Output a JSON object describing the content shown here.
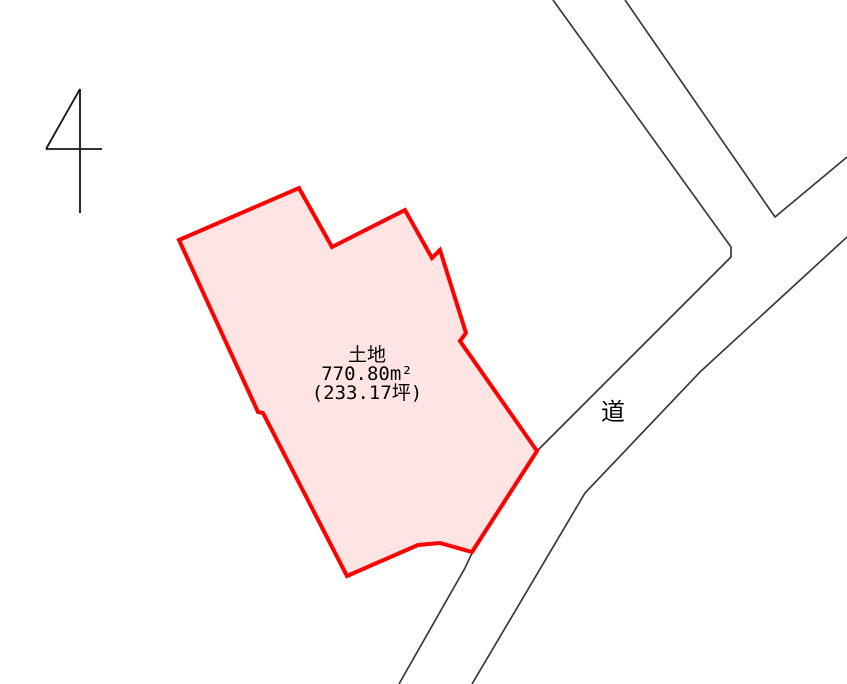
{
  "canvas": {
    "width": 847,
    "height": 684,
    "background": "#ffffff"
  },
  "colors": {
    "parcel_fill": "#fee4e2",
    "parcel_stroke": "#ff0000",
    "road_stroke": "#3a3a3a",
    "text": "#000000"
  },
  "north_arrow": {
    "strokes": [
      "80,89 80,213",
      "46,149 102,149",
      "80,89 46,149"
    ]
  },
  "parcel": {
    "points": "179,240 299,188 332,247 405,210 432,258 440,250 466,333 460,341 537,451 472,552 440,543 418,545 347,576 263,413 258,412",
    "label": {
      "title": "土地",
      "area_m2": "770.80m²",
      "area_tsubo": "(233.17坪)"
    }
  },
  "roads": {
    "label": "道",
    "edges": [
      "553,0 731,247 731,257 537,451",
      "625,0 775,217 847,157",
      "847,237 700,372 585,493 472,684",
      "472,553 465,568 399,684"
    ]
  }
}
